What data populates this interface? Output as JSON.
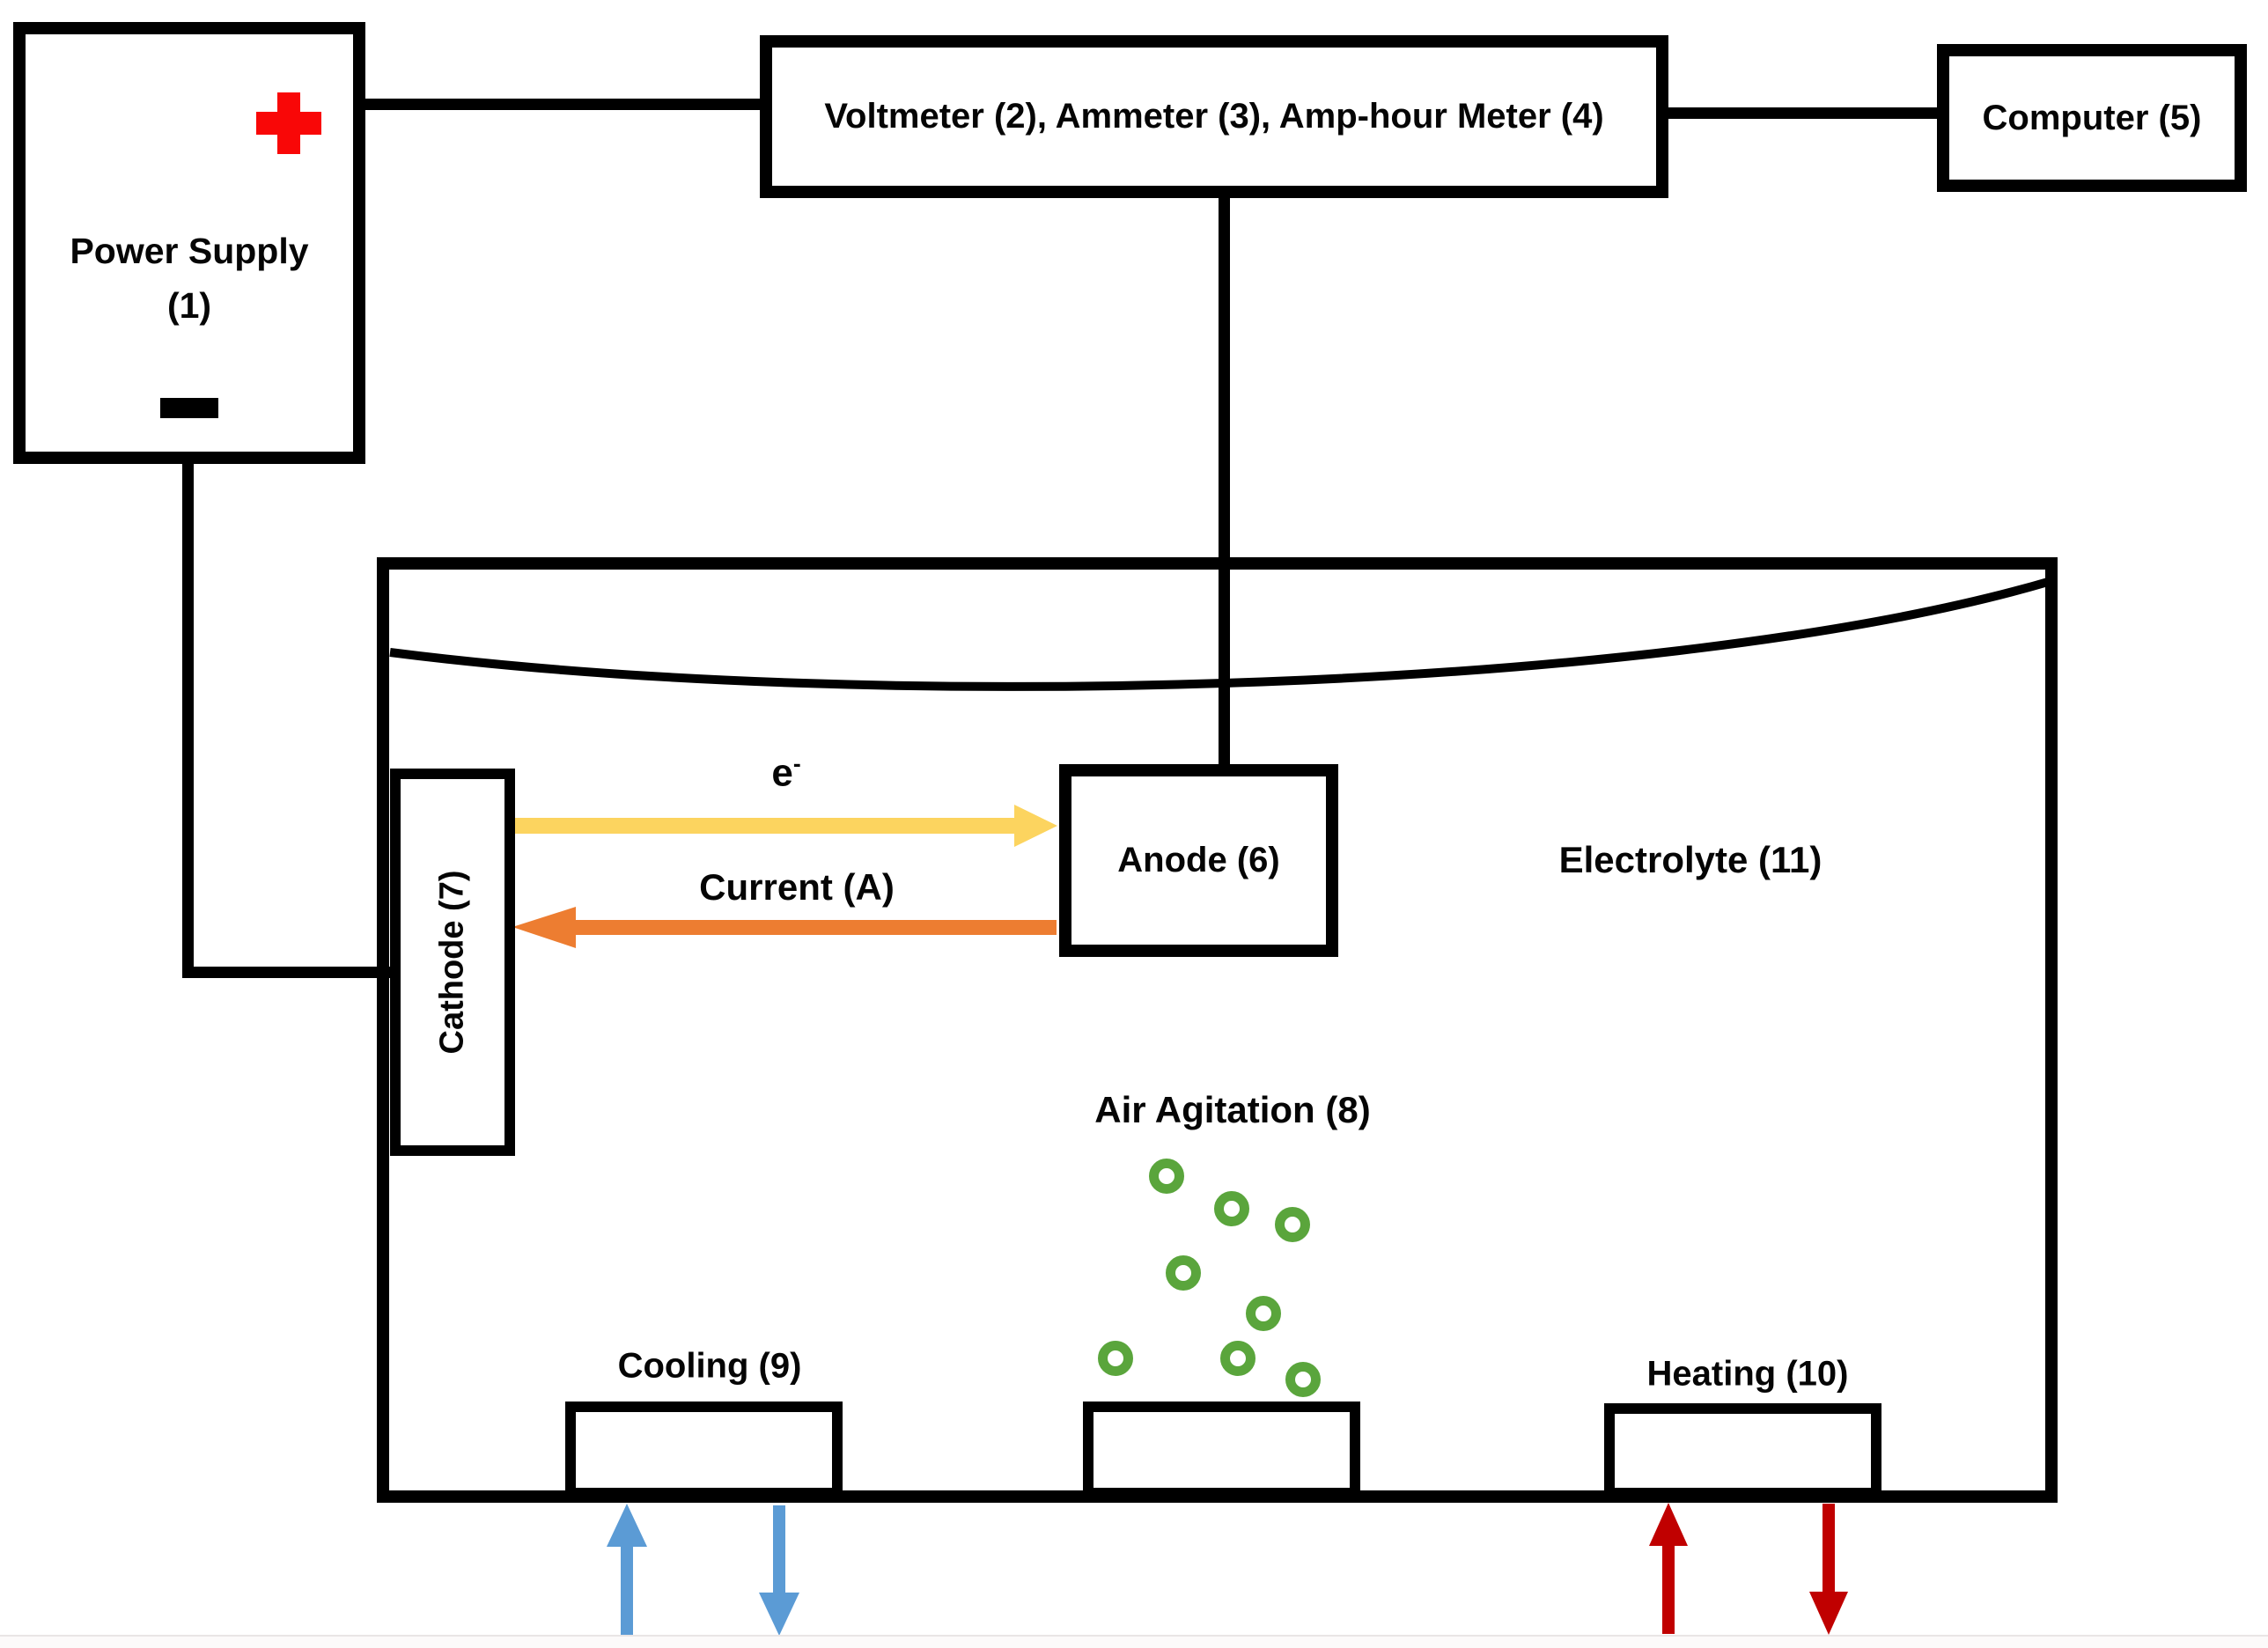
{
  "diagram_title": "Electroplating cell schematic",
  "colors": {
    "line_black": "#000000",
    "terminal_red": "#f90707",
    "electron_yellow": "#fcd45f",
    "current_orange": "#ed7d31",
    "bubble_green": "#5aa53c",
    "cooling_blue": "#5b9bd5",
    "heating_red": "#c00000"
  },
  "components": {
    "power_supply": {
      "label_line1": "Power Supply",
      "label_line2": "(1)"
    },
    "meter": {
      "label": "Voltmeter (2), Ammeter (3), Amp-hour Meter (4)"
    },
    "computer": {
      "label": "Computer (5)"
    },
    "anode": {
      "label": "Anode (6)"
    },
    "cathode": {
      "label": "Cathode (7)"
    },
    "air_agitation": {
      "label": "Air Agitation (8)",
      "bubble_count": 8
    },
    "cooling": {
      "label": "Cooling (9)"
    },
    "heating": {
      "label": "Heating (10)"
    },
    "electrolyte": {
      "label": "Electrolyte (11)"
    }
  },
  "annotations": {
    "electron_flow_base": "e",
    "electron_flow_sup": "-",
    "current_label": "Current (A)"
  }
}
